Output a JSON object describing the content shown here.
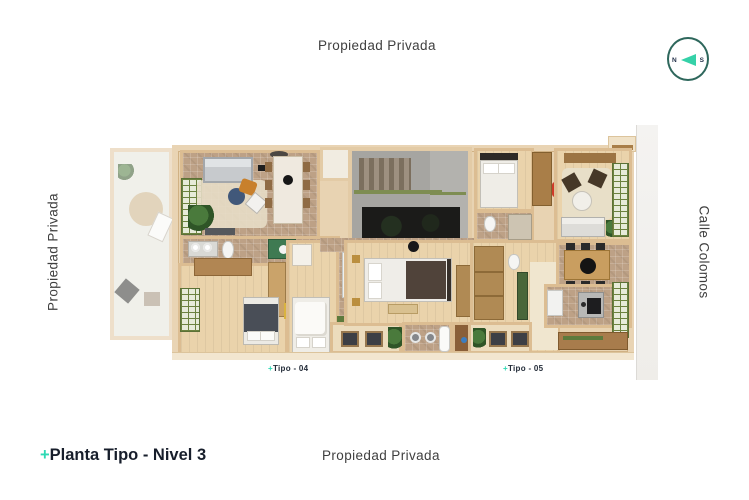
{
  "labels": {
    "top": "Propiedad Privada",
    "left": "Propiedad Privada",
    "right": "Calle Colomos",
    "bottom": "Propiedad Privada"
  },
  "title": {
    "plus": "+",
    "text": "Planta Tipo - Nivel 3"
  },
  "units": [
    {
      "plus": "+",
      "label": "Tipo - 04"
    },
    {
      "plus": "+",
      "label": "Tipo - 05"
    }
  ],
  "compass": {
    "west": "N",
    "east": "S"
  },
  "colors": {
    "accent": "#2ed9b4",
    "compass_ring": "#2e675c",
    "title_text": "#171e2b",
    "label_text": "#3f3f3f",
    "wall_tan": "#e8d3b2",
    "tile_floor": "#bda186",
    "wood_floor": "#ead3ab",
    "core_gray": "#a6a5a1",
    "void_dark": "#1b1b19"
  }
}
